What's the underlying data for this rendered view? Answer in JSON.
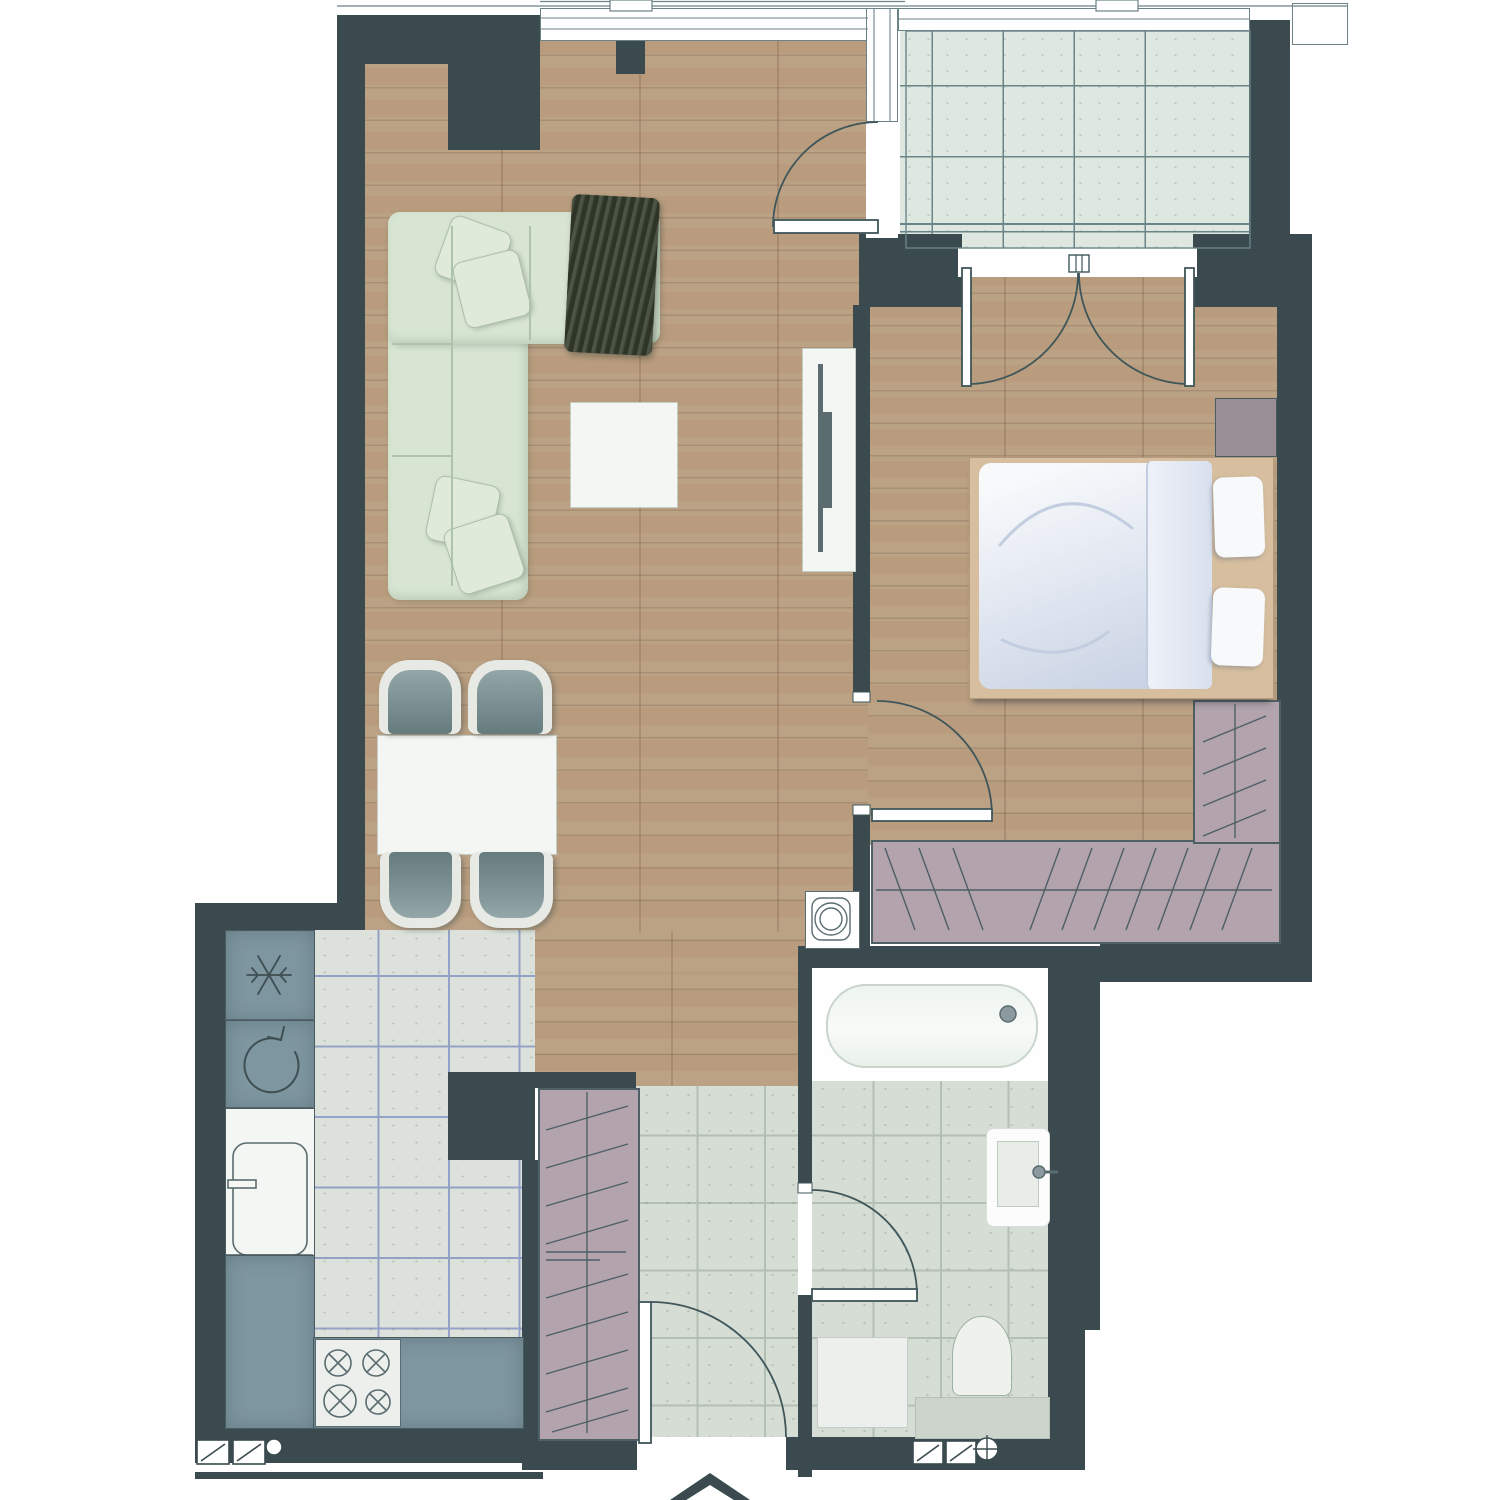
{
  "document": {
    "kind": "residential apartment floor plan (top-down architectural drawing)",
    "visible_text": []
  },
  "colors": {
    "wall": "#3A4A4E",
    "wood": "#B89C7D",
    "kitchenTile": "#DCE2DB",
    "kitchenGrid": "#93A1C6",
    "bathTile": "#D6DDD5",
    "bathGrid": "#B2BFB3",
    "balconyTile": "#DFE7E1",
    "balconyGrid": "#6A8588",
    "counter": "#7E96A0",
    "counterEdge": "#4A5B60",
    "closet": "#B2A3AD",
    "closetLine": "#4E5F66",
    "sofa": "#D8E5D3",
    "sofaSeam": "#AFC3AA",
    "pillow": "#DFEADB",
    "throw": "#384131",
    "white": "#F4F6F3",
    "furnOutline": "#C5CDC7",
    "chairRim": "#E7E9E4",
    "chairSeat": "#7E9396",
    "bedFrame": "#D6BE9E",
    "duvet": "#E4E9F2",
    "duvetDeep": "#C7D1E3",
    "linen": "#F7F9FB",
    "nightstand": "#9A8E97",
    "tub": "#FDFEFD",
    "tubInner": "#F0F5F1",
    "fixture": "#5A6C70",
    "arc": "#3F565A",
    "windowLine": "#6B8287",
    "ledge": "#CCD4CB",
    "appliance": "#EDEFEC"
  },
  "rooms": [
    {
      "name": "living-dining-room",
      "floor": "wood-plank",
      "furniture": [
        "corner-sofa",
        "throw-blanket",
        "scatter-cushions",
        "coffee-table",
        "tv-unit",
        "dining-table",
        "dining-chairs-x4"
      ]
    },
    {
      "name": "kitchen",
      "floor": "gridded-tile",
      "fixtures": [
        "tall-unit-snowflake-symbol",
        "appliance-rotation-symbol",
        "kitchen-sink-with-tap",
        "worktop-run",
        "hob-4-burners"
      ]
    },
    {
      "name": "hallway",
      "floor": "tile",
      "fixtures": [
        "built-in-closet-hatched",
        "entrance-door-with-arrow",
        "vent-fixture-double-circle"
      ]
    },
    {
      "name": "bathroom",
      "floor": "tile",
      "fixtures": [
        "bathtub-with-drain",
        "washbasin-with-tap",
        "toilet",
        "washing-machine-square",
        "boxed-ledge"
      ]
    },
    {
      "name": "bedroom",
      "floor": "wood-plank",
      "furniture": [
        "double-bed",
        "bed-pillows-x2",
        "nightstand",
        "wardrobe-hatched-l-shape"
      ]
    },
    {
      "name": "balcony",
      "floor": "large-format-tile",
      "fixtures": [
        "glazed-railing"
      ]
    }
  ],
  "symbols": [
    "snowflake-icon",
    "rotation-arrow-icon",
    "burner-cross-icon",
    "vent-grille-icon",
    "crosshair-drain-icon",
    "entrance-arrow-icon",
    "door-swing-arc",
    "french-door-double-arc",
    "window-glazing-lines",
    "wardrobe-hatch-lines",
    "double-circle-fan-icon"
  ]
}
